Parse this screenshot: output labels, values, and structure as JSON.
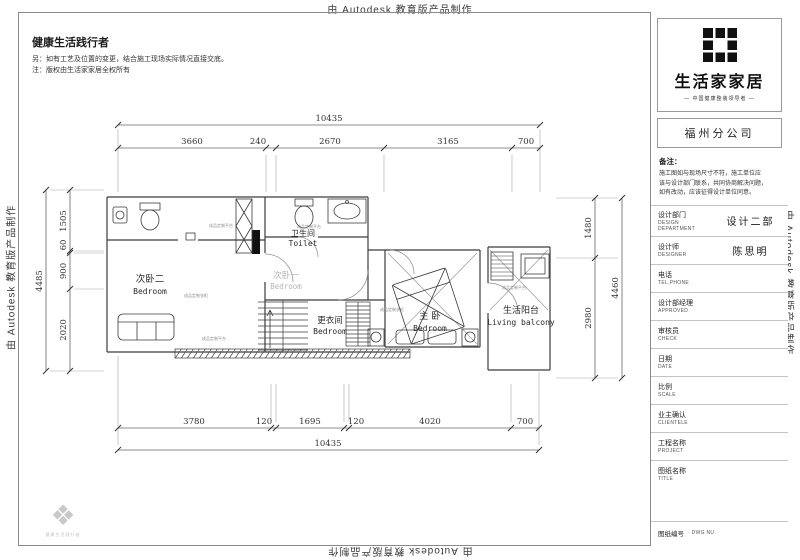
{
  "watermark": {
    "text": "由 Autodesk 教育版产品制作"
  },
  "header": {
    "title": "健康生活践行者",
    "note1": "另：如有工艺及位置的变更，结合施工现场实际情况直接交底。",
    "note2": "注：版权由生活家家居全权所有"
  },
  "titleblock": {
    "brand": "生活家家居",
    "tagline": "— 中国健康整装领导者 —",
    "branch": "福州分公司",
    "remarks": {
      "title": "备注：",
      "lines": [
        "施工图如与现场尺寸不符，施工单位应",
        "该与设计部门联系，共同协商解决问题，",
        "如有改动，应该征得设计单位同意。"
      ]
    },
    "fields": [
      {
        "cn": "设计部门",
        "en": "DESIGN DEPARTMENT",
        "value": "设计二部"
      },
      {
        "cn": "设计师",
        "en": "DESIGNER",
        "value": "陈思明"
      },
      {
        "cn": "电话",
        "en": "TEL.PHONE",
        "value": ""
      },
      {
        "cn": "设计部经理",
        "en": "APPROVED",
        "value": ""
      },
      {
        "cn": "审核员",
        "en": "CHECK",
        "value": ""
      },
      {
        "cn": "日期",
        "en": "DATE",
        "value": ""
      },
      {
        "cn": "比例",
        "en": "SCALE",
        "value": ""
      },
      {
        "cn": "业主确认",
        "en": "CLIENTELE",
        "value": ""
      },
      {
        "cn": "工程名称",
        "en": "PROJECT",
        "value": ""
      },
      {
        "cn": "图纸名称",
        "en": "TITLE",
        "value": ""
      },
      {
        "cn": "图纸编号",
        "en": "· DWG NU",
        "value": ""
      }
    ]
  },
  "plan": {
    "rooms": [
      {
        "cn": "次卧二",
        "en": "Bedroom"
      },
      {
        "cn": "卫生间",
        "en": "Toilet"
      },
      {
        "cn": "次卧一",
        "en": "Bedroom"
      },
      {
        "cn": "更衣间",
        "en": "Bedroom"
      },
      {
        "cn": "主 卧",
        "en": "Bedroom"
      },
      {
        "cn": "生活阳台",
        "en": "Living balcony"
      }
    ],
    "dims": {
      "top_total": "10435",
      "top_segments": [
        "3660",
        "240",
        "2670",
        "3165",
        "700"
      ],
      "bottom_segments": [
        "3780",
        "120",
        "1695",
        "120",
        "4020",
        "700"
      ],
      "bottom_total": "10435",
      "left_total": "4485",
      "left_segments": [
        "1505",
        "60",
        "900",
        "2020"
      ],
      "right_segments": [
        "1480",
        "2980"
      ],
      "right_total": "4460"
    },
    "annotations": [
      "成品定制平台",
      "成品定制衣柜",
      "成品定制平台",
      "成品定制平台",
      "成品定制衣柜",
      "成品定制平台"
    ]
  },
  "corner": {
    "caption": "健康生活践行者"
  }
}
